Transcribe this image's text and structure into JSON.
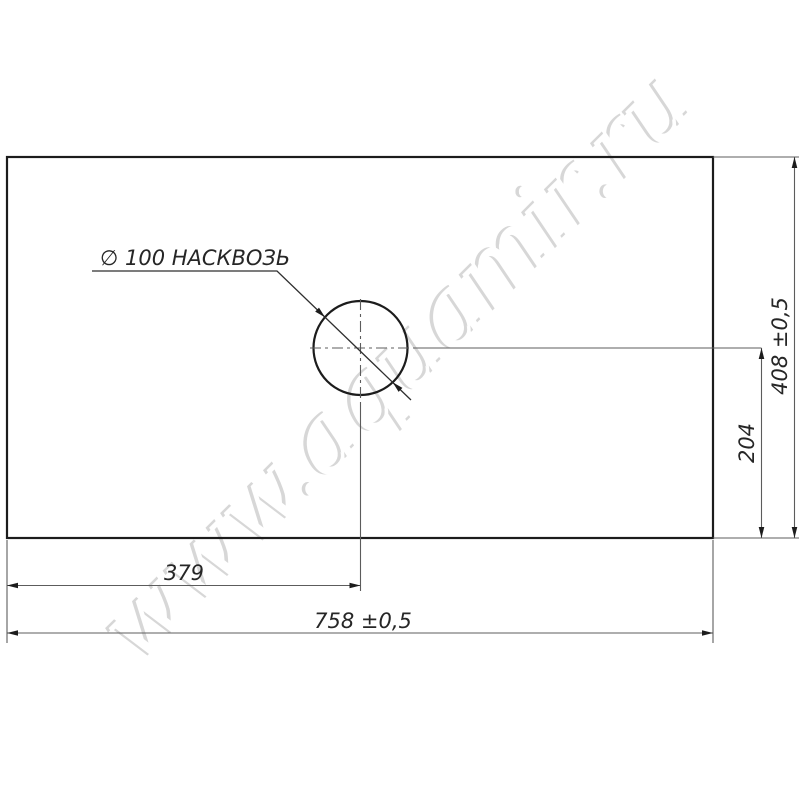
{
  "drawing": {
    "hole_label": "∅ 100 НАСКВОЗЬ",
    "watermark": "www.aquamir.ru",
    "dimensions": {
      "width_total": "758 ±0,5",
      "width_to_hole_center": "379",
      "height_total": "408 ±0,5",
      "height_to_hole_center": "204"
    },
    "colors": {
      "outline": "#1c1c1c",
      "dimension_line": "#5c5c5c",
      "text": "#262626",
      "watermark_shadow": "#d7d7d7",
      "background": "#ffffff"
    }
  }
}
